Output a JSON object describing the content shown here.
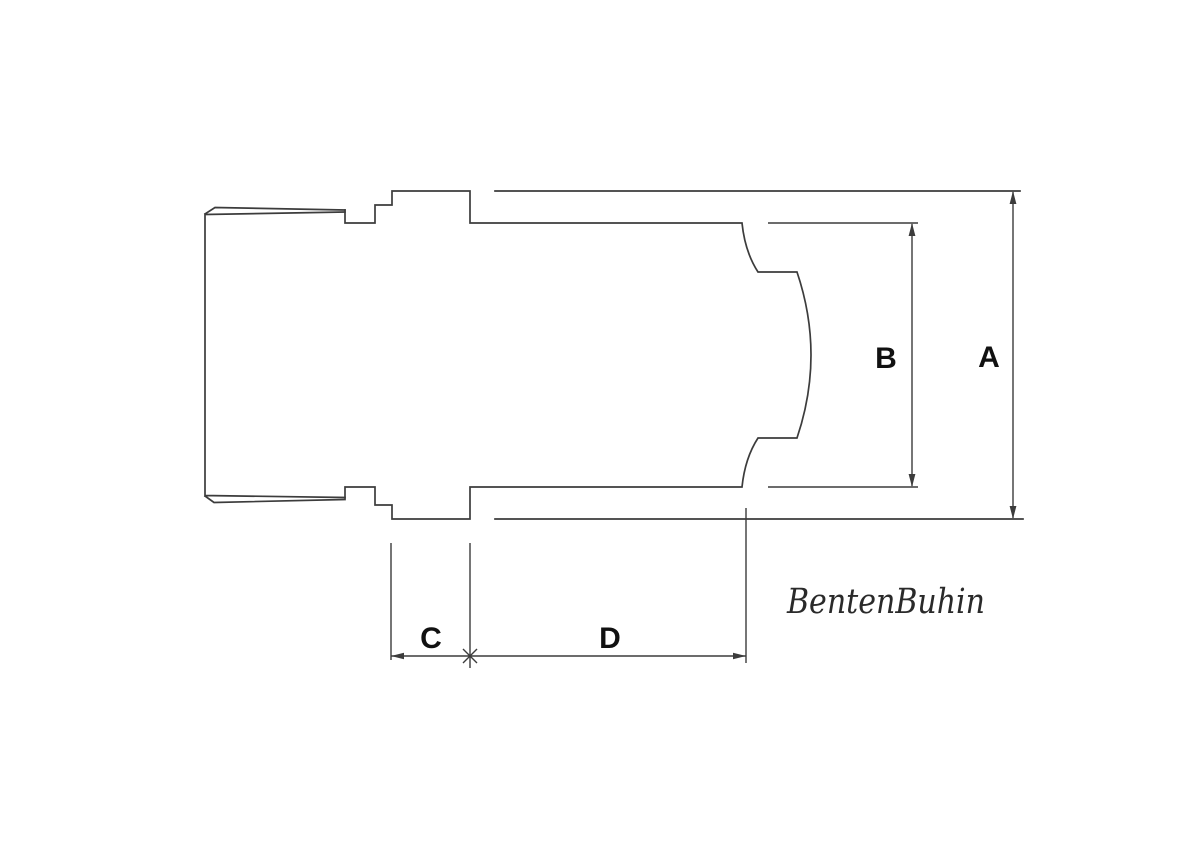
{
  "drawing": {
    "kind": "technical-line-drawing",
    "labels": {
      "a": "A",
      "b": "B",
      "c": "C",
      "d": "D"
    },
    "watermark": "BentenBuhin",
    "colors": {
      "line": "#3c3c3c",
      "label": "#111111",
      "watermark": "#2a2a2a",
      "background": "#ffffff"
    }
  }
}
